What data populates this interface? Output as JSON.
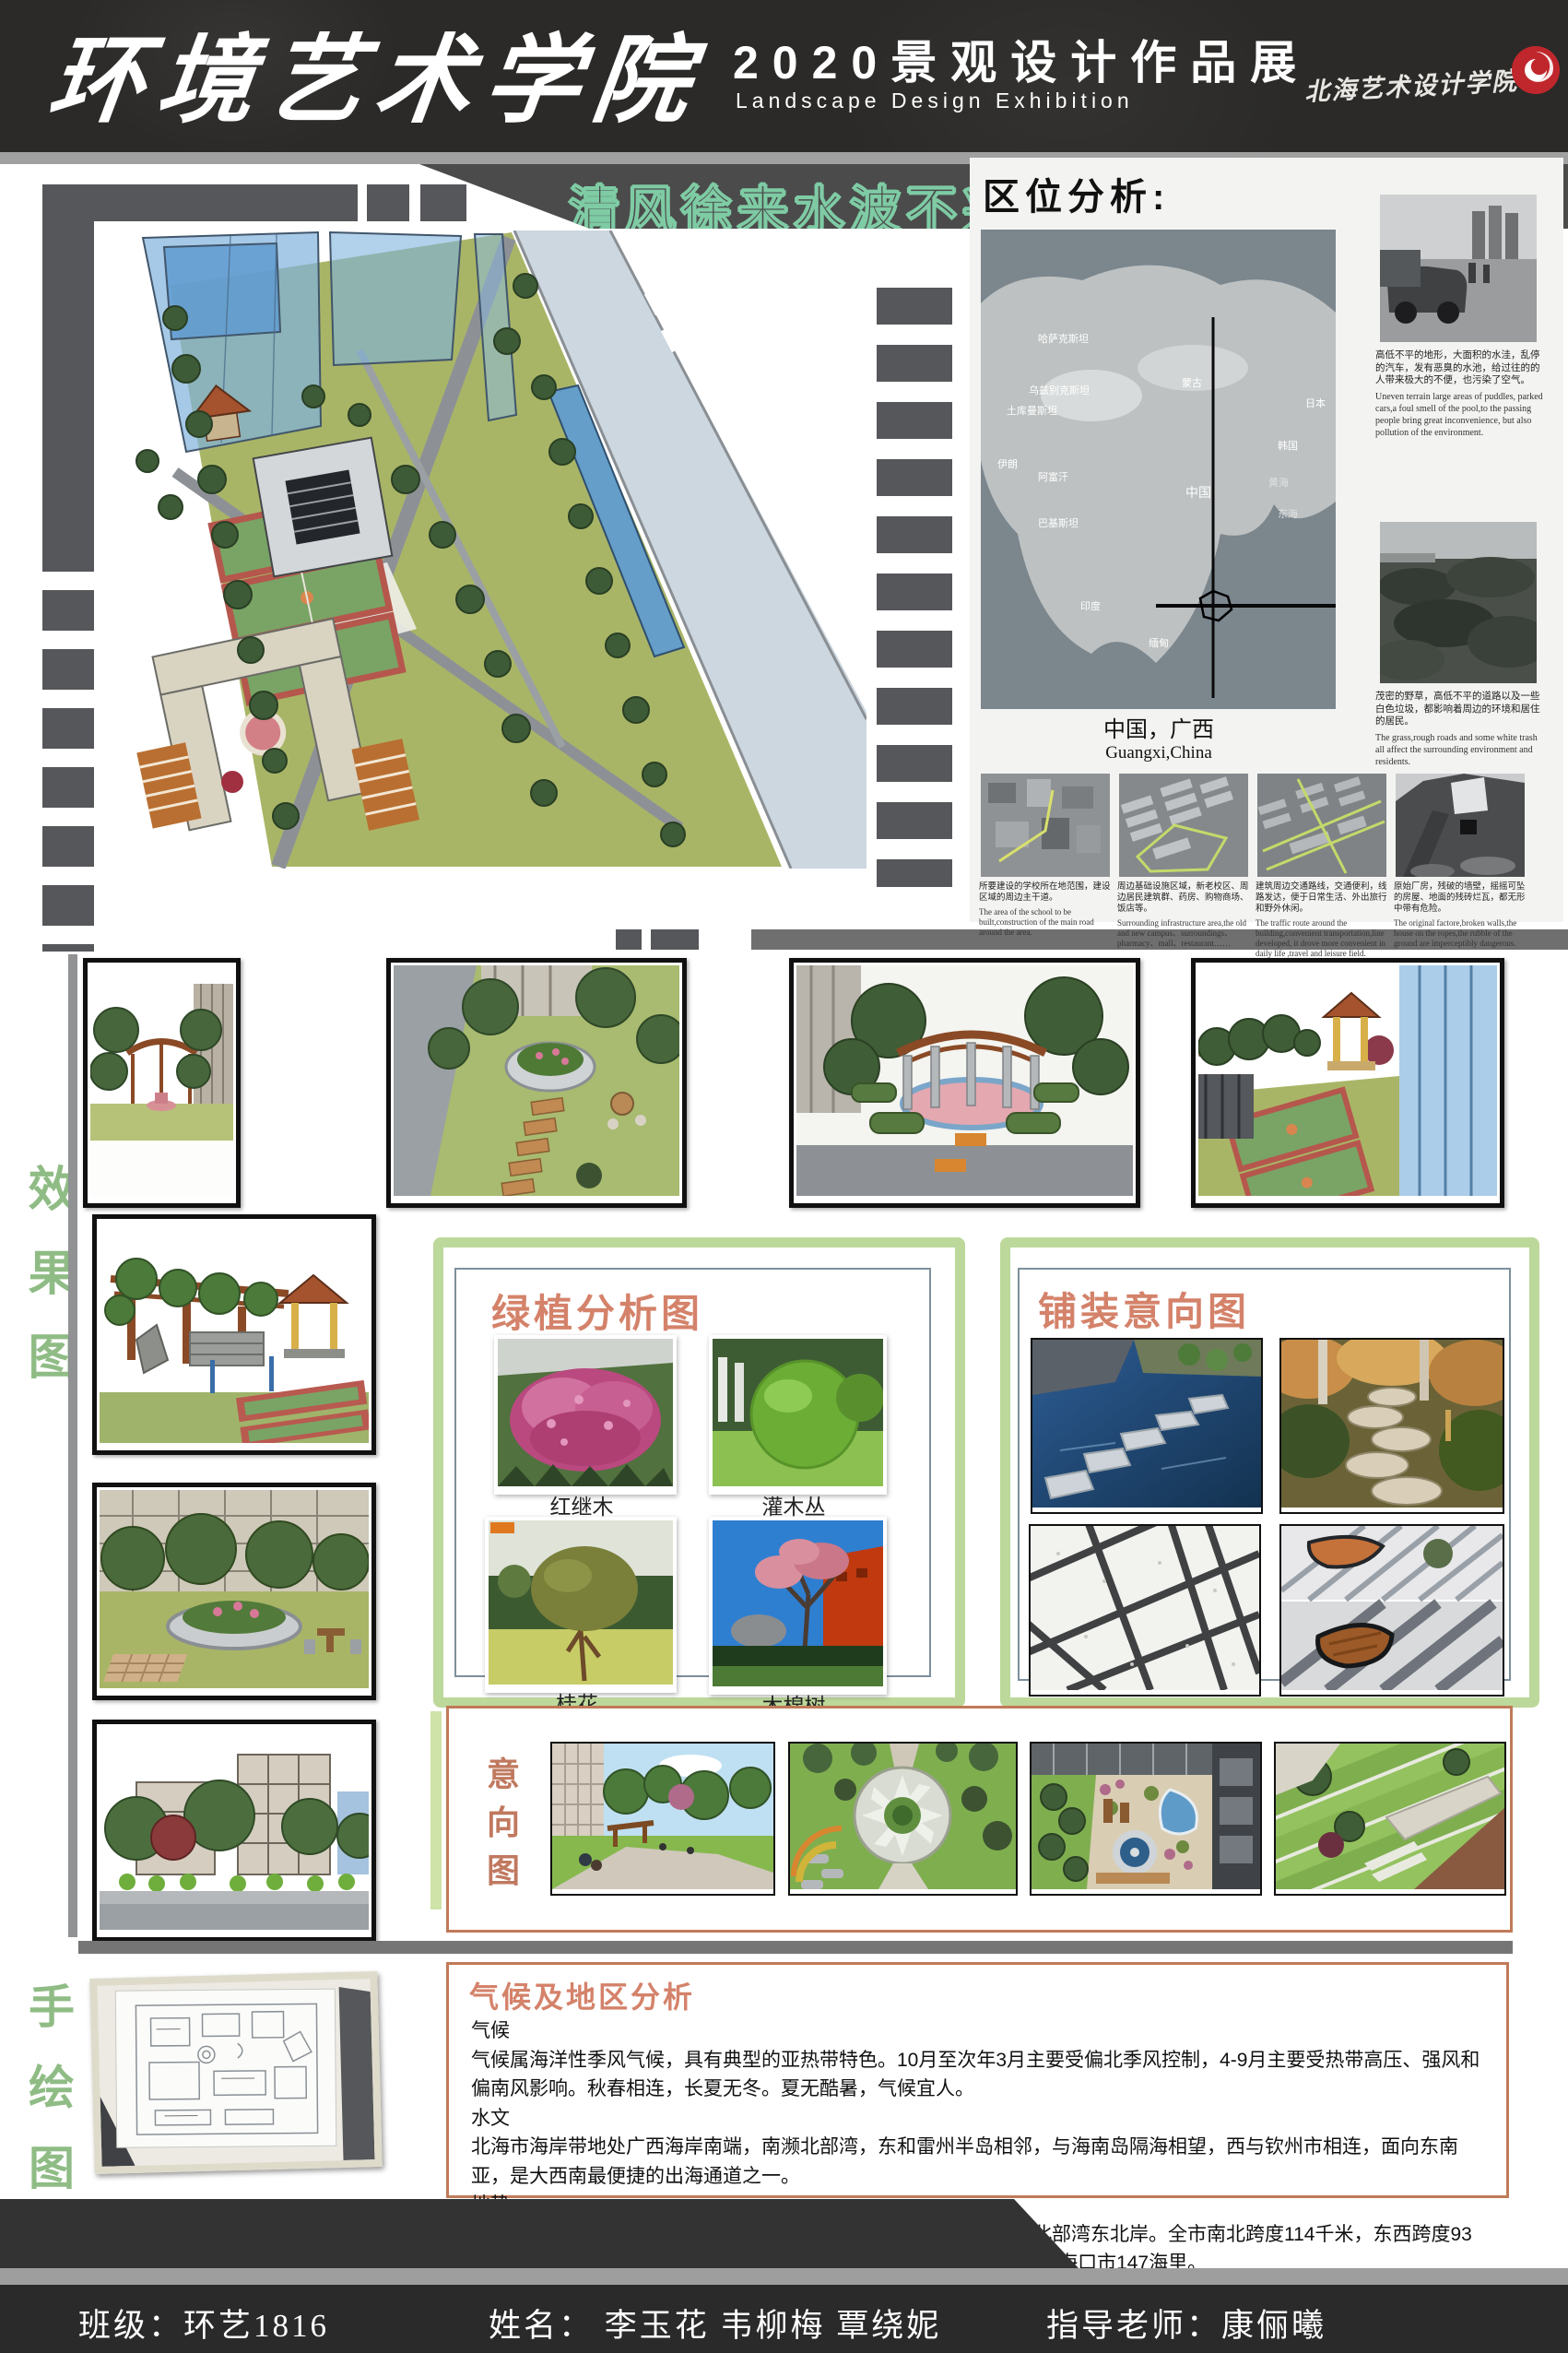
{
  "header": {
    "school_name": "环境艺术学院",
    "exhibition_title_cn": "2020景观设计作品展",
    "exhibition_title_en": "Landscape Design Exhibition",
    "institute_signature": "北海艺术设计学院",
    "logo_color": "#c0272d"
  },
  "banner": {
    "slogan": "清风徐来水波不兴",
    "campus": "南校区",
    "outline_color": "#7ecba4"
  },
  "location_analysis": {
    "title": "区位分析:",
    "map": {
      "labels": [
        "哈萨克斯坦",
        "乌兹别克斯坦",
        "土库曼斯坦",
        "伊朗",
        "阿富汗",
        "巴基斯坦",
        "印度",
        "缅甸",
        "蒙古",
        "中国",
        "日本",
        "韩国",
        "黄海",
        "东海"
      ],
      "caption_cn": "中国，广西",
      "caption_en": "Guangxi,China"
    },
    "side_notes": [
      {
        "cn": "高低不平的地形，大面积的水洼，乱停的汽车，发有恶臭的水池，给过往的的人带来极大的不便，也污染了空气。",
        "en": "Uneven terrain large areas of puddles, parked cars,a foul smell of the pool,to the passing people bring great inconvenience, but also pollution of the environment."
      },
      {
        "cn": "茂密的野草，高低不平的道路以及一些白色垃圾，都影响着周边的环境和居住的居民。",
        "en": "The grass,rough roads and some white trash all affect the surrounding environment and residents."
      }
    ],
    "site_notes": [
      {
        "cn": "所要建设的学校所在地范围，建设区域的周边主干道。",
        "en": "The area of the school to be built,construction of the main road around the area."
      },
      {
        "cn": "周边基础设施区域，新老校区、周边居民建筑群、药房、购物商场、饭店等。",
        "en": "Surrounding infrastructure area,the old and new campus、surroundings、pharmacy、mall、restaurant……"
      },
      {
        "cn": "建筑周边交通路线，交通便利，线路发达，便于日常生活、外出旅行和野外休闲。",
        "en": "The traffic route around the building,convenient transportation,line developed, it drove more convenient in daily life ,travel and leisure field."
      },
      {
        "cn": "原始厂房，残破的墙壁，摇摇可坠的房屋、地面的残砖烂瓦，都无形中带有危险。",
        "en": "The original factore,broken walls,the house on the ropes,the rubble of the ground are imperceptibly dangerous."
      }
    ]
  },
  "section_labels": {
    "effect": "效果图",
    "sketch": "手绘图"
  },
  "green_analysis": {
    "title": "绿植分析图",
    "plants": [
      {
        "name": "红继木"
      },
      {
        "name": "灌木丛"
      },
      {
        "name": "桂花"
      },
      {
        "name": "木棉树"
      }
    ]
  },
  "paving": {
    "title": "铺装意向图"
  },
  "intention": {
    "title": "意向图"
  },
  "climate": {
    "title": "气候及地区分析",
    "paragraphs": [
      "气候",
      "气候属海洋性季风气候，具有典型的亚热带特色。10月至次年3月主要受偏北季风控制，4-9月主要受热带高压、强风和偏南风影响。秋春相连，长夏无冬。夏无酷暑，气候宜人。",
      "水文",
      "北海市海岸带地处广西海岸南端，南濒北部湾，东和雷州半岛相邻，与海南岛隔海相望，西与钦州市相连，面向东南亚，是大西南最便捷的出海通道之一。",
      "地势",
      "地势总体呈北高南低，地势平坦开阔。地处广西壮族自治区南端，北部湾东北岸。全市南北跨度114千米，东西跨度93千米。西北距首府南宁206公里，东距广东湛江198公里，东南距海南海口市147海里。"
    ]
  },
  "footer": {
    "class_info": "班级：环艺1816",
    "names": "姓名：  李玉花  韦柳梅  覃绕妮",
    "advisor": "指导老师：康俪曦"
  }
}
